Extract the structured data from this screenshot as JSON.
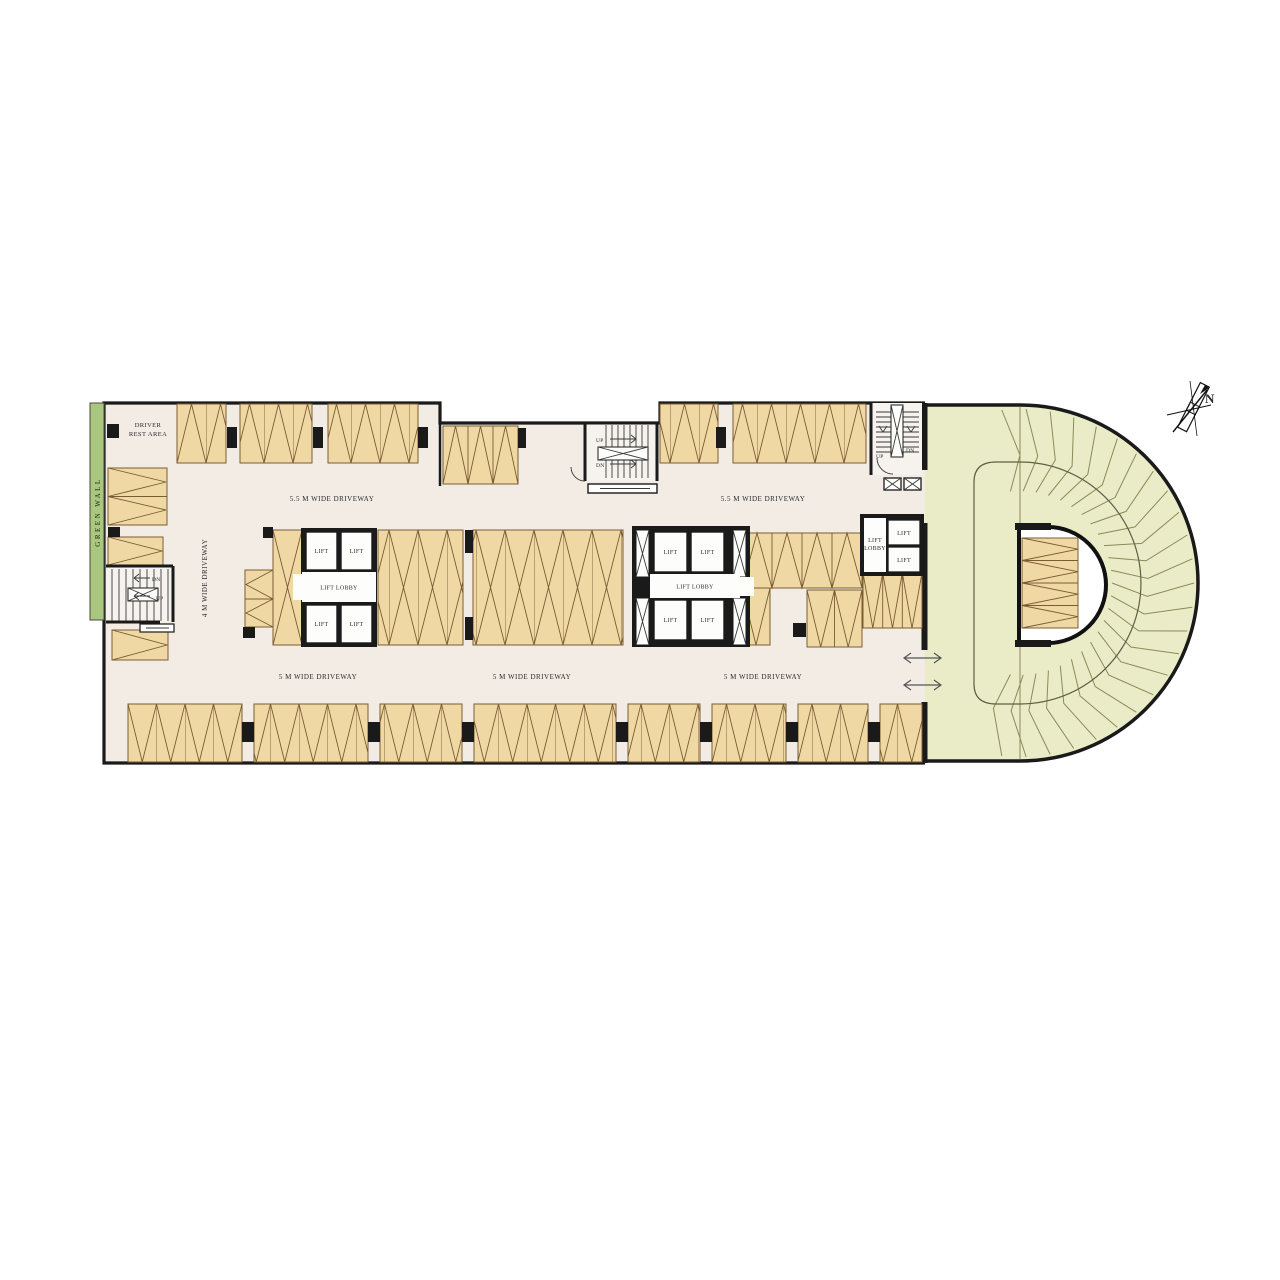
{
  "north_arrow": {
    "label": "N"
  },
  "green_wall": {
    "label": "GREEN WALL"
  },
  "driver_rest_area": {
    "line1": "DRIVER",
    "line2": "REST AREA"
  },
  "driveways": {
    "top_left": "5.5 M WIDE DRIVEWAY",
    "top_right": "5.5 M WIDE DRIVEWAY",
    "left_vertical": "4 M WIDE DRIVEWAY",
    "bottom_left": "5 M WIDE DRIVEWAY",
    "bottom_center": "5 M WIDE DRIVEWAY",
    "bottom_right": "5 M WIDE DRIVEWAY"
  },
  "lift_core": {
    "lift": "LIFT",
    "lobby": "LIFT LOBBY",
    "lobby_line1": "LIFT",
    "lobby_line2": "LOBBY"
  },
  "stairs": {
    "up": "UP",
    "dn": "DN"
  },
  "colors": {
    "floor": "#f2ece4",
    "parking_fill": "#f0d8a5",
    "parking_line": "#7a5c33",
    "landscape": "#e9ecc7",
    "landscape_line": "#8a8a58",
    "green_wall": "#a9c77e",
    "wall": "#1a1a1a"
  }
}
